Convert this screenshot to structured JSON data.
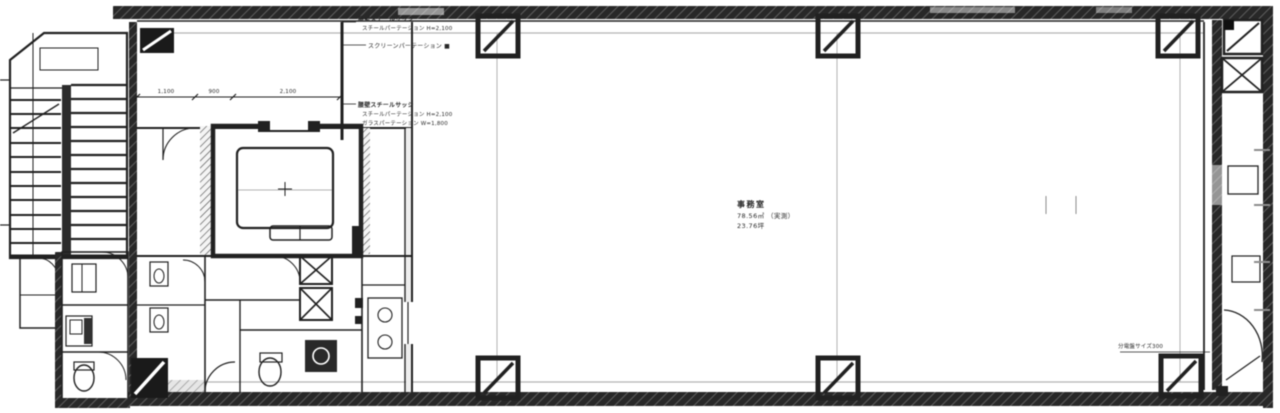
{
  "drawing": {
    "annotations": {
      "block1": {
        "line1": "腰壁スチールサッシ",
        "line2": "スチールパーテーション H=2,100",
        "line3": "スクリーンパーテーション ■"
      },
      "block2": {
        "line1": "腰壁スチールサッシ",
        "line2": "スチールパーテーション H=2,100",
        "line3": "ガラスパーテーション W=1,800"
      }
    },
    "room_label": {
      "name": "事務室",
      "area": "78.56㎡ （実測）",
      "tsubo": "23.76坪"
    },
    "equipment_label": "分電盤サイズ300",
    "dimensions": {
      "d1": "1,100",
      "d2": "900",
      "d3": "2,100"
    }
  },
  "colors": {
    "ink": "#232323",
    "wall": "#2a2a2a",
    "faint": "#b2b2b2",
    "background": "#ffffff"
  }
}
